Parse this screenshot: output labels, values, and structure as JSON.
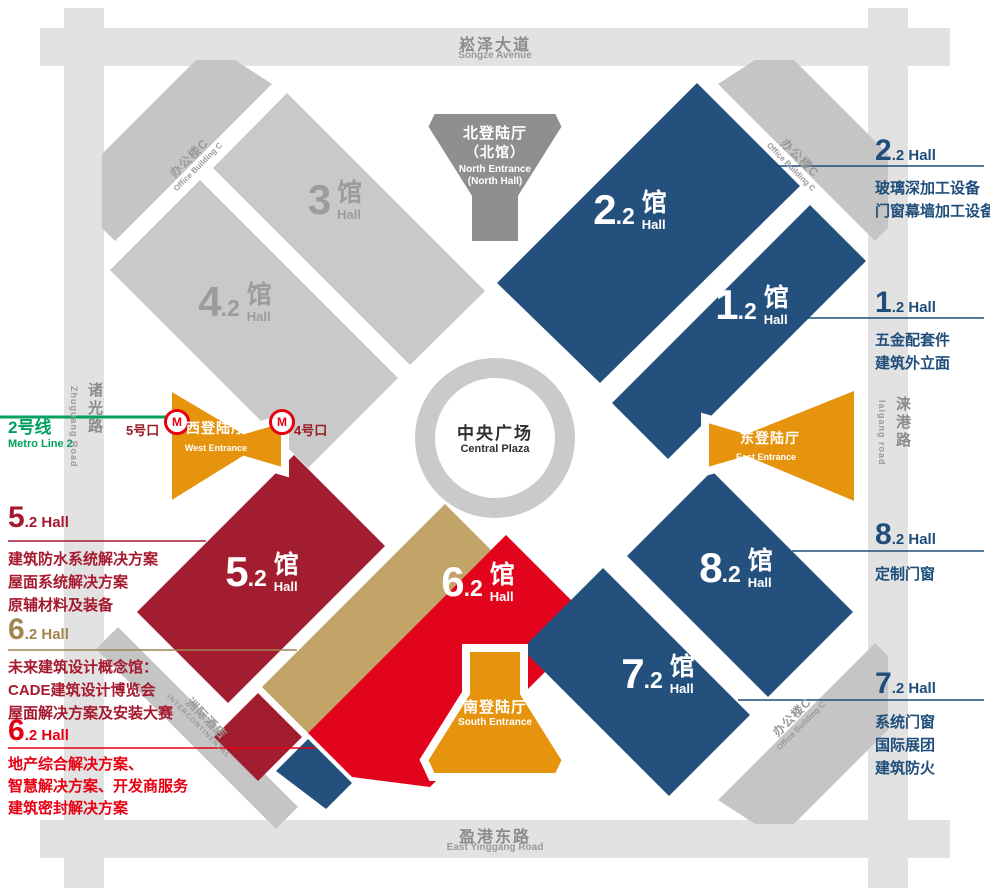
{
  "colors": {
    "hall_blue": "#24507D",
    "hall_gray": "#C9C9C9",
    "hall_dark_red": "#A21D2F",
    "hall_bright_red": "#E2041C",
    "hall_tan": "#C2A368",
    "entrance_orange": "#E6940E",
    "north_entrance_gray": "#8F8F8F",
    "road_gray": "#E2E2E2",
    "building_gray": "#C5C5C5",
    "plaza_ring_gray": "#CACACA",
    "annotation_blue": "#1F4E7B",
    "annotation_dark_red": "#A6192E",
    "annotation_tan": "#A1854F",
    "annotation_bright_red": "#E60012",
    "metro_green": "#00A05E",
    "metro_logo_red": "#E60012",
    "exit_text_red": "#9B1C23"
  },
  "roads": {
    "top": {
      "zh": "崧泽大道",
      "en": "Songze Avenue"
    },
    "bottom": {
      "zh": "盈港东路",
      "en": "East Yinggang Road"
    },
    "left": {
      "zh": "诸光路",
      "en": "Zhuguang Road"
    },
    "right": {
      "zh": "涞港路",
      "en": "laigang road"
    }
  },
  "metro": {
    "line_zh": "2号线",
    "line_en": "Metro Line 2",
    "exit_5": "5号口",
    "exit_4": "4号口",
    "logo_letter": "M"
  },
  "plaza": {
    "zh": "中央广场",
    "en": "Central Plaza"
  },
  "entrances": {
    "north": {
      "zh1": "北登陆厅",
      "zh2": "（北馆）",
      "en1": "North Entrance",
      "en2": "(North Hall)"
    },
    "south": {
      "zh": "南登陆厅",
      "en": "South Entrance"
    },
    "west": {
      "zh": "西登陆厅",
      "en": "West Entrance"
    },
    "east": {
      "zh": "东登陆厅",
      "en": "East Entrance"
    }
  },
  "buildings": {
    "office_c": {
      "zh": "办公楼C",
      "en": "Office Building C"
    },
    "hotel": {
      "zh": "洲际酒店",
      "en": "INTERCONTINENTAL"
    }
  },
  "halls": {
    "h3": {
      "digit": "3",
      "dec": "",
      "guan": "馆",
      "hall": "Hall"
    },
    "h42": {
      "digit": "4",
      "dec": ".2",
      "guan": "馆",
      "hall": "Hall"
    },
    "h22": {
      "digit": "2",
      "dec": ".2",
      "guan": "馆",
      "hall": "Hall"
    },
    "h12": {
      "digit": "1",
      "dec": ".2",
      "guan": "馆",
      "hall": "Hall"
    },
    "h52": {
      "digit": "5",
      "dec": ".2",
      "guan": "馆",
      "hall": "Hall"
    },
    "h62": {
      "digit": "6",
      "dec": ".2",
      "guan": "馆",
      "hall": "Hall"
    },
    "h82": {
      "digit": "8",
      "dec": ".2",
      "guan": "馆",
      "hall": "Hall"
    },
    "h72": {
      "digit": "7",
      "dec": ".2",
      "guan": "馆",
      "hall": "Hall"
    }
  },
  "annotations": {
    "r22": {
      "digit": "2",
      "suffix": ".2 Hall",
      "lines": [
        "玻璃深加工设备",
        "门窗幕墙加工设备"
      ]
    },
    "r12": {
      "digit": "1",
      "suffix": ".2 Hall",
      "lines": [
        "五金配套件",
        "建筑外立面"
      ]
    },
    "r82": {
      "digit": "8",
      "suffix": ".2 Hall",
      "lines": [
        "定制门窗"
      ]
    },
    "r72": {
      "digit": "7",
      "suffix": ".2 Hall",
      "lines": [
        "系统门窗",
        "国际展团",
        "建筑防火"
      ]
    },
    "l52": {
      "digit": "5",
      "suffix": ".2 Hall",
      "lines": [
        "建筑防水系统解决方案",
        "屋面系统解决方案",
        "原辅材料及装备"
      ]
    },
    "l62t": {
      "digit": "6",
      "suffix": ".2 Hall",
      "lines": [
        "未来建筑设计概念馆：",
        "CADE建筑设计博览会",
        "屋面解决方案及安装大赛"
      ]
    },
    "l62r": {
      "digit": "6",
      "suffix": ".2 Hall",
      "lines": [
        "地产综合解决方案、",
        "智慧解决方案、开发商服务",
        "建筑密封解决方案"
      ]
    }
  }
}
